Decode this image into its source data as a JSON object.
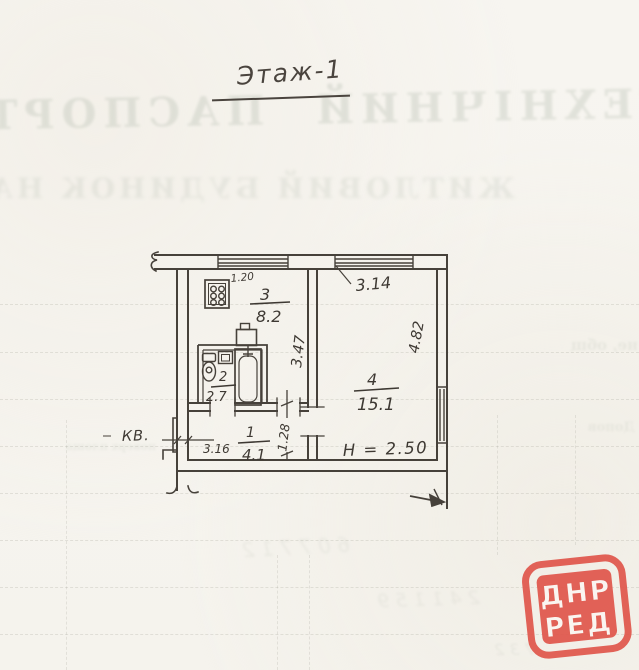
{
  "document": {
    "floor_title": "Этаж-1"
  },
  "plan": {
    "apartment_label": "КВ.",
    "ceiling_height": "H = 2.50",
    "rooms": [
      {
        "number": "1",
        "area": "4.1"
      },
      {
        "number": "2",
        "area": "2.7"
      },
      {
        "number": "3",
        "area": "8.2"
      },
      {
        "number": "4",
        "area": "15.1"
      }
    ],
    "dimensions": {
      "stove_wall": "1.20",
      "room4_window_width": "3.14",
      "kitchen_depth": "3.47",
      "room4_depth": "4.82",
      "hall_width": "3.16",
      "hall_door": "1.28"
    }
  },
  "stamp": {
    "line1": "ДНР",
    "line2": "РЕД",
    "color": "#e0564b"
  },
  "bleedthrough": {
    "header_mirrored": "ТЕХНІЧНИЙ ПАСПОРТ",
    "subheader_mirrored": "ЖИТЛОВИЙ БУДИНОК НА",
    "fragment_right": "не, общ",
    "fragment_table_left": "поверх площа",
    "fragment_table_right": "Допов",
    "hand_numbers_1": "6 0 7 7 1 2",
    "hand_numbers_2": "2 4 1 1 5 9",
    "hand_numbers_3": "7 3 2"
  }
}
